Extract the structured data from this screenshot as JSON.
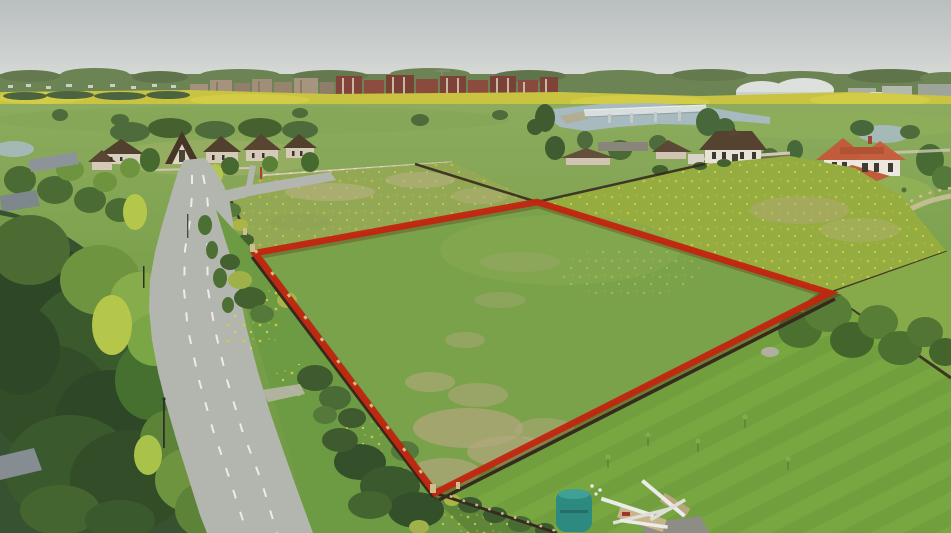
{
  "scene": {
    "description": "Aerial drone photograph of a rural land plot outlined with a red boundary line, beside a curving asphalt road with dashed markings, a pine forest, cottage houses, meadows with dandelions, a river with a concrete bridge and rows of brick apartment blocks on the horizon under a pale overcast sky."
  },
  "colors": {
    "sky_top": "#b9bfc0",
    "sky_horizon": "#d8dbd7",
    "treeline": "#6c8354",
    "village_light": "#c9cec7",
    "brick_building": "#82443a",
    "beige_building": "#a3917b",
    "building_stripe": "#c9b8a0",
    "dome_white": "#dde1de",
    "industrial_gray": "#aab0a6",
    "rapeseed_yellow": "#c9c342",
    "field_light": "#8cab5e",
    "field_mid": "#7ba14c",
    "field_dark": "#6e9942",
    "meadow_upper": "#93a854",
    "meadow_bright": "#95ac40",
    "dandelion": "#ddc832",
    "river": "#a7bac0",
    "bridge": "#d8dedd",
    "cottage_roof": "#50402d",
    "cottage_wall": "#d9cfc0",
    "white_house_wall": "#e7e3d9",
    "white_house_roof": "#55432f",
    "terracotta_roof": "#c05c3c",
    "stone_fence": "#d2c9b2",
    "fence_dark": "#362b20",
    "fence_post": "#cfbd8d",
    "forest_dark": "#365231",
    "forest_mid": "#4a6b33",
    "tree_light": "#6f9440",
    "tree_yellow": "#b5c74b",
    "road": "#b3b6af",
    "road_marking": "#eef0e9",
    "boundary_red": "#c2250f",
    "lawn": "#74a23f",
    "lawn_stripe": "#7cab45",
    "tank_teal": "#2d8a80",
    "lumber_white": "#ebebe7",
    "debris_tan": "#c6b48b",
    "roof_gray": "#8d9499",
    "tarp_blue": "#4c7da0",
    "dry_patch": "#b3a87e",
    "plot_grass": "#7aa24a"
  }
}
